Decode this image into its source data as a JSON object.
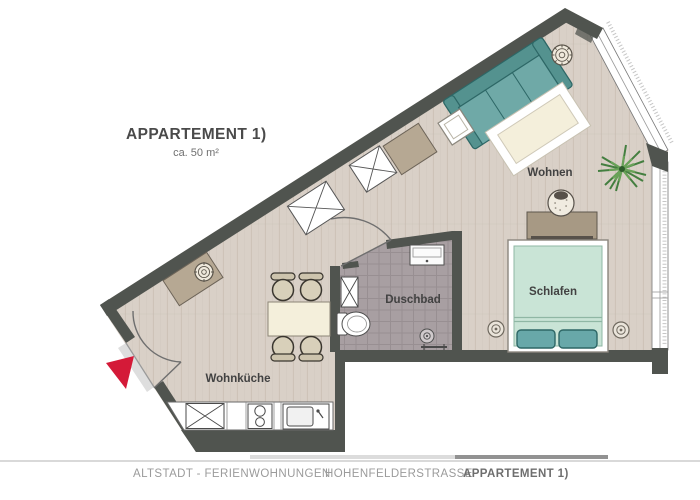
{
  "title": {
    "heading": "APPARTEMENT 1)",
    "subtitle": "ca. 50 m²"
  },
  "rooms": {
    "living": "Wohnen",
    "sleeping": "Schlafen",
    "bathroom": "Duschbad",
    "kitchen": "Wohnküche"
  },
  "footer": {
    "items": [
      {
        "label": "ALTSTADT - FERIENWOHNUNGEN",
        "active": false
      },
      {
        "label": "HOHENFELDERSTRASSE",
        "active": false
      },
      {
        "label": "APPARTEMENT 1)",
        "active": true
      }
    ]
  },
  "colors": {
    "wall": "#50544f",
    "floor": "#d9d0c7",
    "plank": "#c4b9ad",
    "tile": "#a89fa2",
    "tileline": "#938b8e",
    "teal": "#6fa9a7",
    "tealdark": "#54928f",
    "tealoutline": "#2d6766",
    "bed": "#c9e4d6",
    "bedline": "#8fb7a4",
    "pillow": "#68a8a9",
    "cream": "#f4efdb",
    "tan": "#b6a893",
    "tandark": "#6d6458",
    "chair": "#d8d0ba",
    "chairback": "#cdc4ad",
    "plantdark": "#3c7a39",
    "plantlight": "#69a258",
    "red": "#d41a38",
    "fix": "#4f4f4f",
    "gray": "#9b9b9b",
    "grayd": "#6e6e6e",
    "line": "#d9d9d9"
  }
}
